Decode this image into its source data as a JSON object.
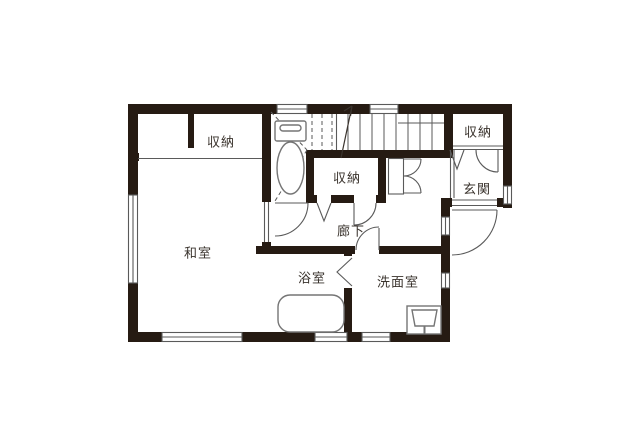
{
  "colors": {
    "wall": "#261b13",
    "line": "#5a5a5a",
    "fixture": "#757575",
    "text": "#3a332d",
    "background": "#ffffff"
  },
  "rooms": {
    "closet_top_left": {
      "label": "収納"
    },
    "closet_middle": {
      "label": "収納"
    },
    "closet_entrance": {
      "label": "収納"
    },
    "entrance": {
      "label": "玄関"
    },
    "japanese_room": {
      "label": "和室"
    },
    "hallway": {
      "label": "廊下"
    },
    "bathroom": {
      "label": "浴室"
    },
    "washroom": {
      "label": "洗面室"
    }
  }
}
